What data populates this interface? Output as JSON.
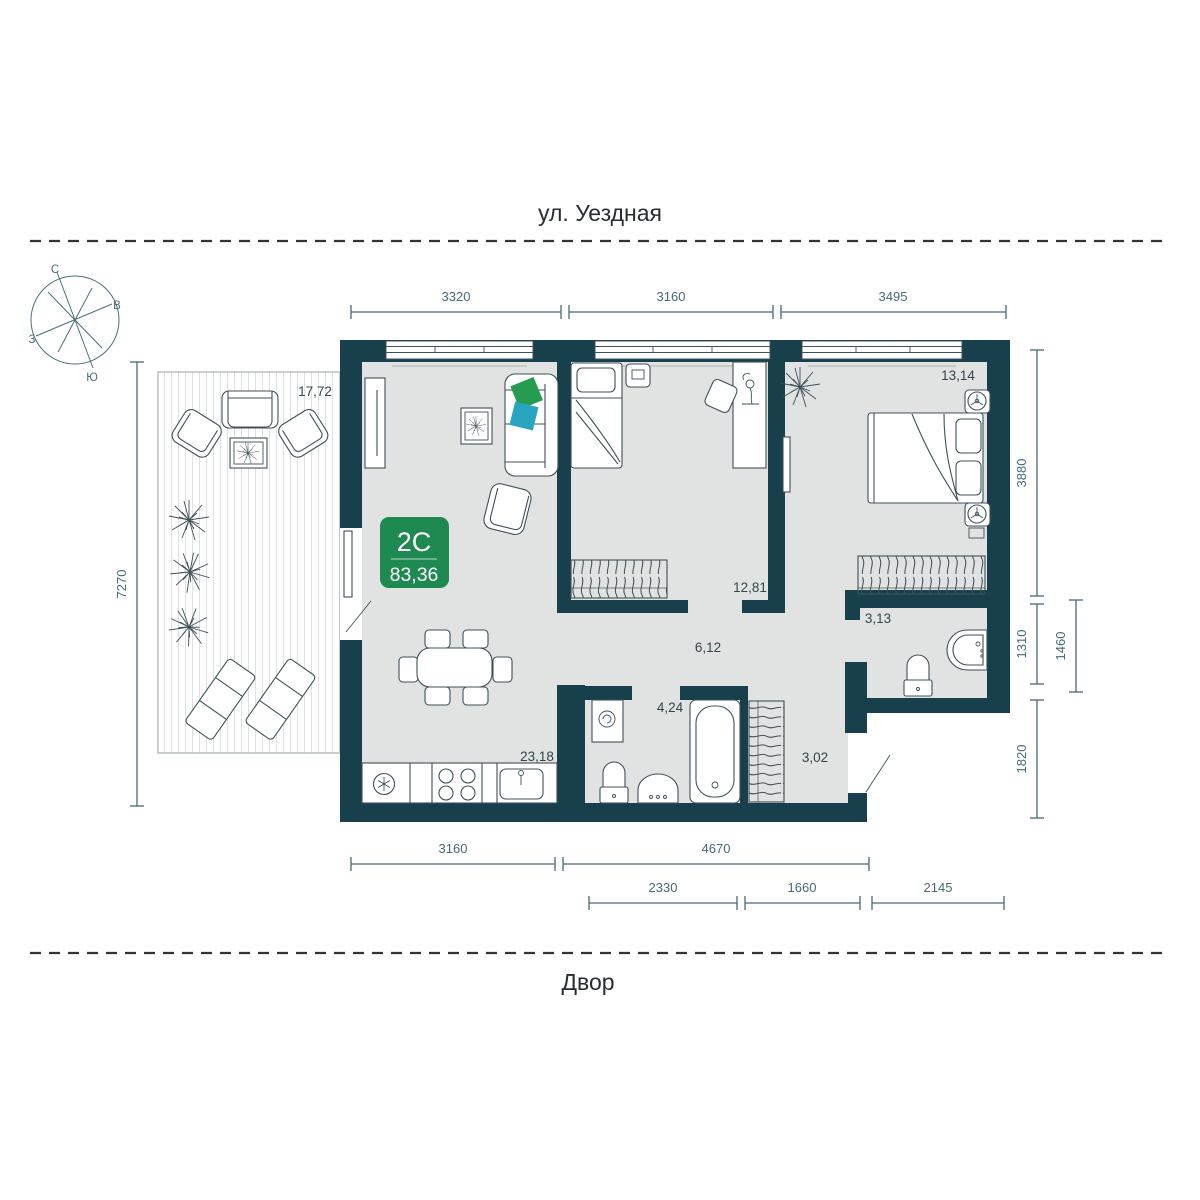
{
  "streets": {
    "top": "ул. Уездная",
    "bottom": "Двор"
  },
  "compass": {
    "north": "С",
    "east": "В",
    "west": "З",
    "south": "Ю"
  },
  "unit_badge": {
    "type": "2С",
    "area": "83,36"
  },
  "room_areas": {
    "terrace": "17,72",
    "living_kitchen": "23,18",
    "bedroom_1": "12,81",
    "bedroom_2": "13,14",
    "hall": "6,12",
    "bathroom": "4,24",
    "entry_hall": "3,02",
    "wc": "3,13"
  },
  "dimensions_mm": {
    "top": [
      "3320",
      "3160",
      "3495"
    ],
    "left": [
      "7270"
    ],
    "right": [
      "3880",
      "1310",
      "1460",
      "1820"
    ],
    "bottom_row_1": [
      "3160",
      "4670"
    ],
    "bottom_row_2": [
      "2330",
      "1660",
      "2145"
    ]
  },
  "colors": {
    "wall": "#17404c",
    "floor": "#e1e2e2",
    "dim": "#456a74",
    "ink": "#33454d",
    "line": "#3f5058",
    "badge": "#1e8a52",
    "badgeText": "#ffffff",
    "pillowGreen": "#259c4f",
    "pillowTeal": "#2aa5c0",
    "street": "#272d31",
    "deckLine": "#dfe1e1",
    "terraceBorder": "#b9c0c2"
  }
}
